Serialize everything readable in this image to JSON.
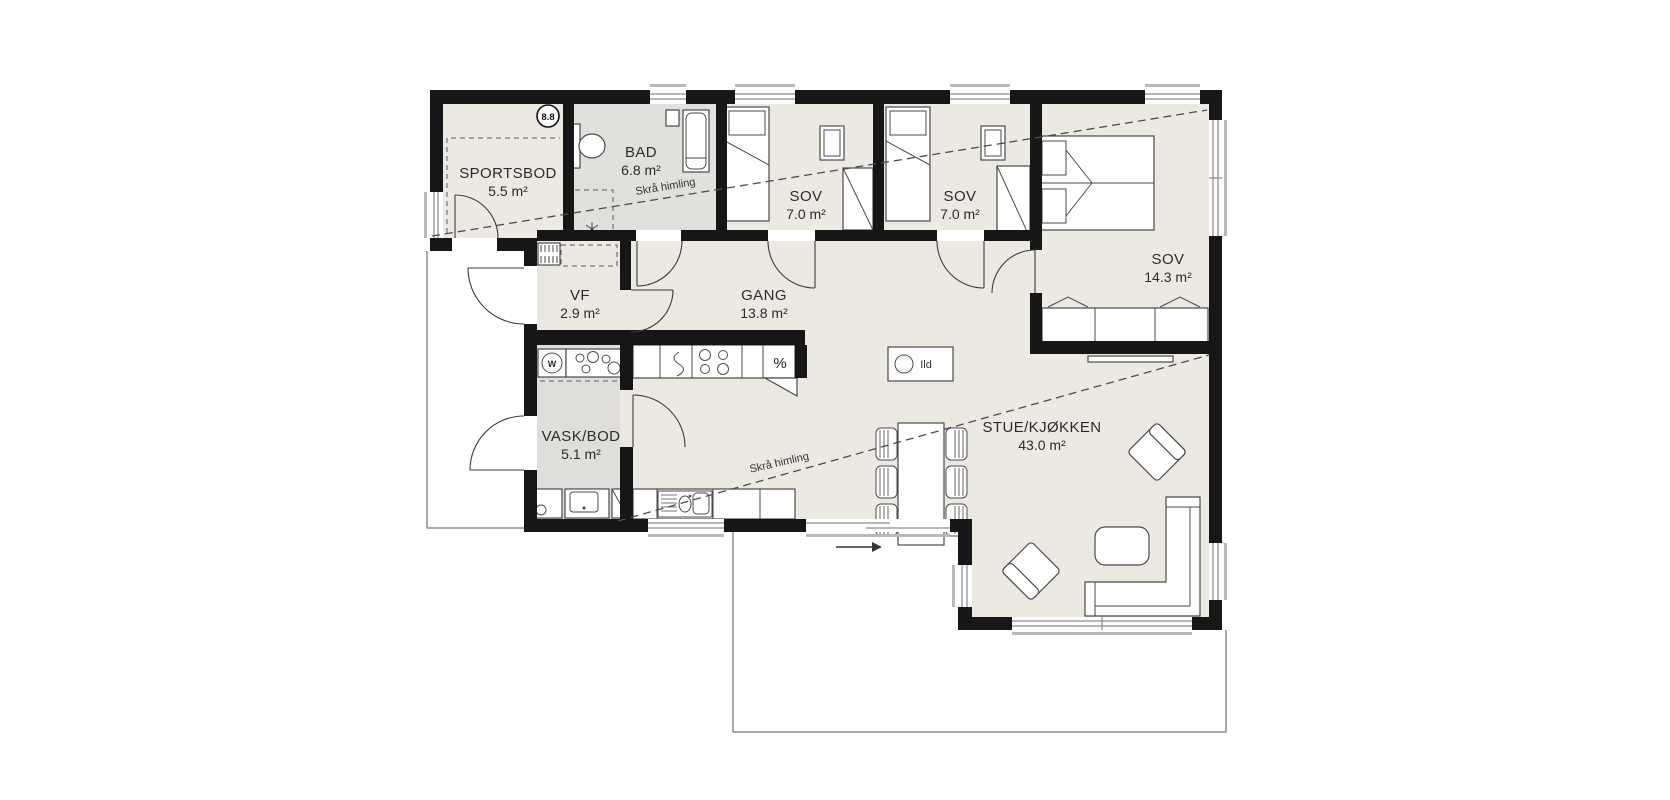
{
  "plan": {
    "title": "floor-plan",
    "rooms": {
      "sportsbod": {
        "name": "SPORTSBOD",
        "area": "5.5 m²"
      },
      "bad": {
        "name": "BAD",
        "area": "6.8 m²"
      },
      "sov1": {
        "name": "SOV",
        "area": "7.0 m²"
      },
      "sov2": {
        "name": "SOV",
        "area": "7.0 m²"
      },
      "sov3": {
        "name": "SOV",
        "area": "14.3 m²"
      },
      "vf": {
        "name": "VF",
        "area": "2.9 m²"
      },
      "gang": {
        "name": "GANG",
        "area": "13.8 m²"
      },
      "vask_bod": {
        "name": "VASK/BOD",
        "area": "5.1 m²"
      },
      "stue_kjokken": {
        "name": "STUE/KJØKKEN",
        "area": "43.0 m²"
      }
    },
    "annotations": {
      "sloped_ceiling": "Skrå himling",
      "fireplace_label": "Ild",
      "ridge_badge": "8.8",
      "washer_label": "W",
      "cooling_symbol": "%"
    },
    "colors": {
      "floor": "#ebe9e2",
      "wet_floor": "#e1e0dd",
      "wall": "#161616"
    }
  }
}
